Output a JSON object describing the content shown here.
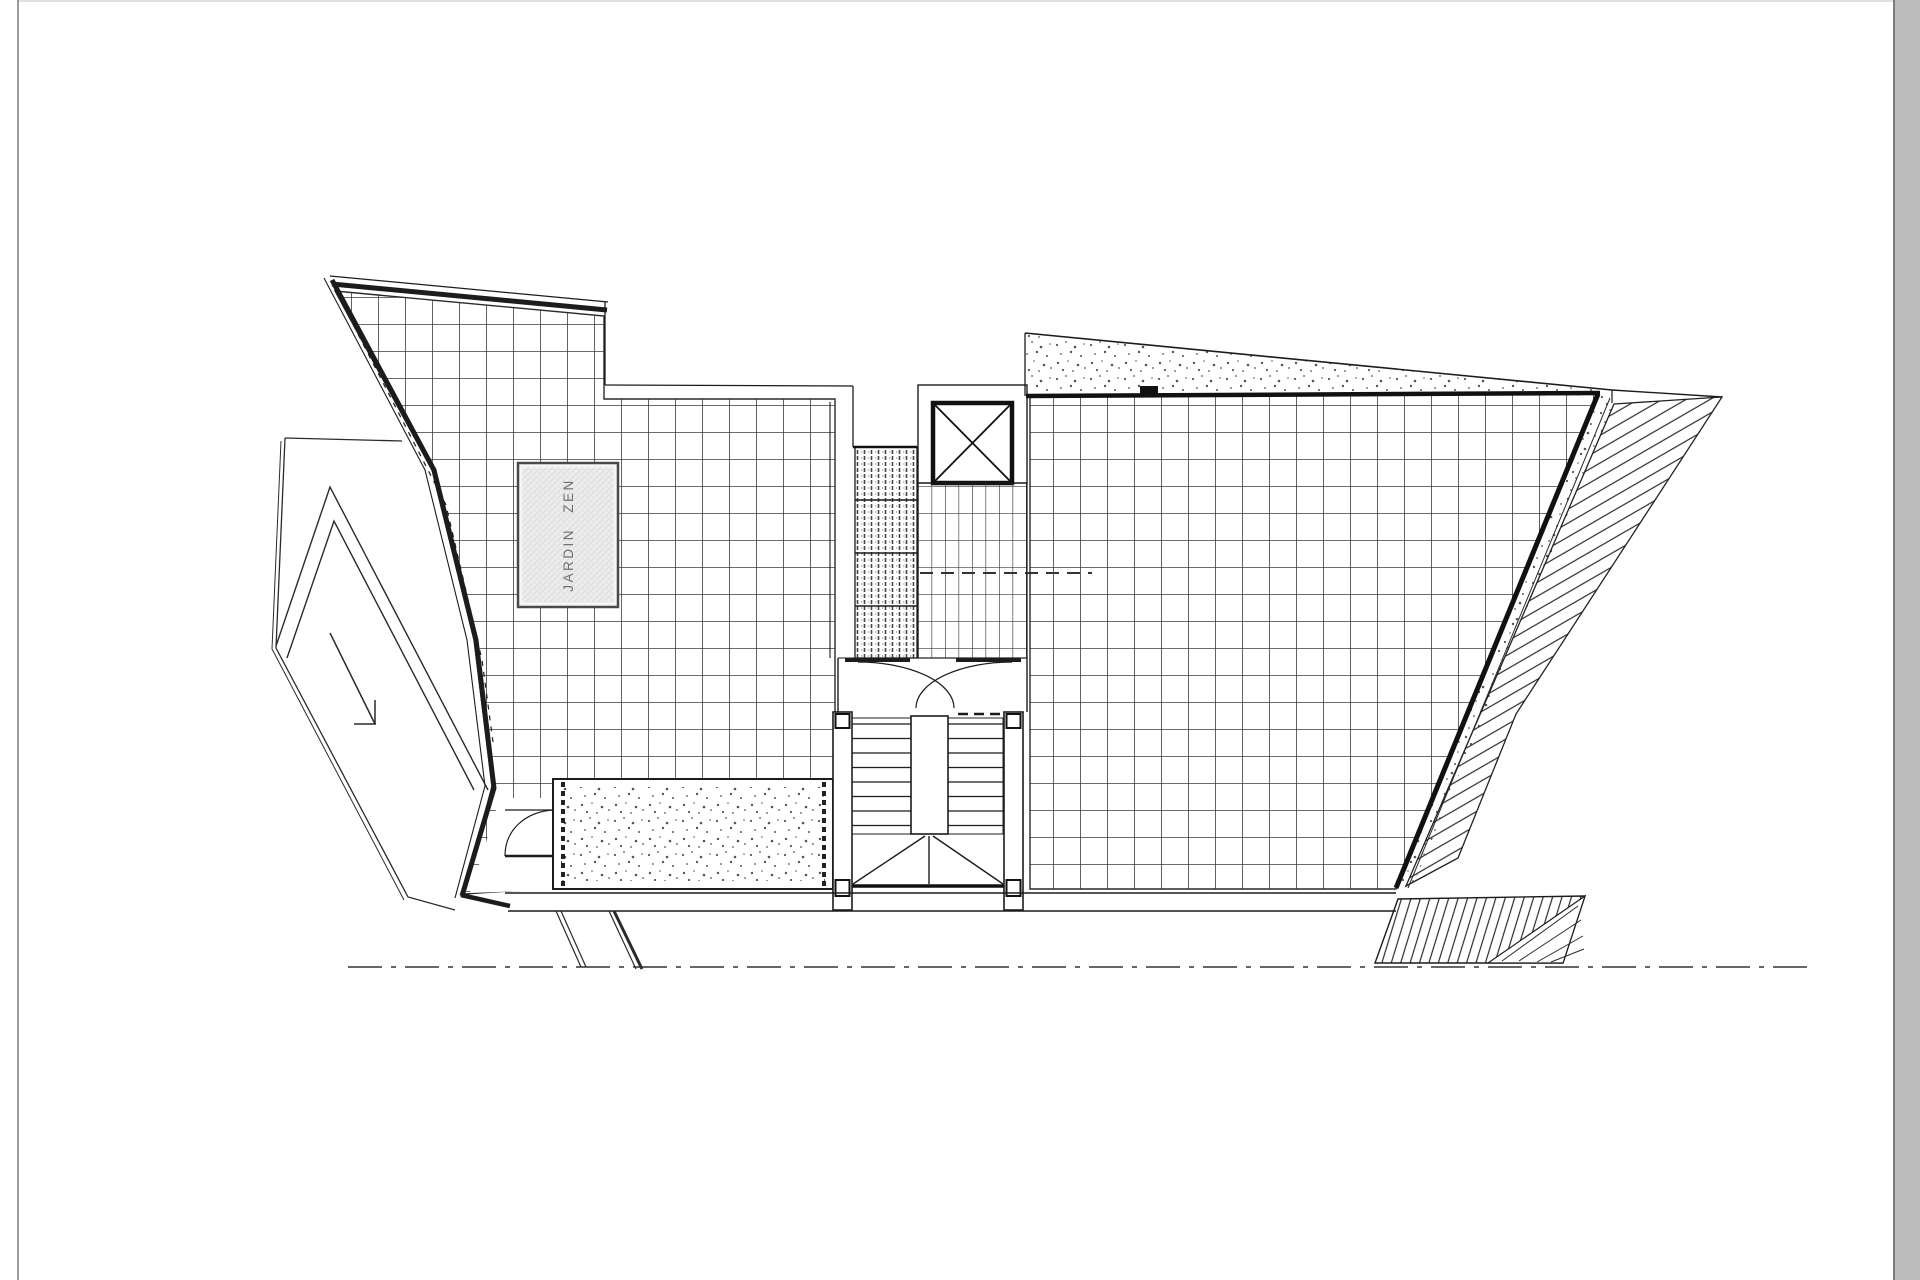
{
  "page": {
    "background": "#ffffff",
    "top_edge_color": "#e0e0e0",
    "left_edge_color": "#9a9a9a",
    "right_bar_color": "#bcbcbc",
    "right_bar_edge_color": "#7d7d7d"
  },
  "drawing": {
    "kind": "architectural-roof-terrace-plan",
    "ink_color": "#1c1c1c",
    "grid_line_color": "#3b3b3b",
    "labels": {
      "zen_garden": "JARDIN ZEN"
    },
    "zen_square": {
      "fill": "#ededed",
      "border": "#4a4a4a",
      "text_color": "#707070"
    },
    "features": [
      "left-tiled-roof-terrace",
      "zen-garden-square",
      "gravel-planter-strip",
      "access-ramp-with-direction-arrow",
      "central-grating-strip",
      "elevator-shaft-with-cross",
      "stair-landing",
      "double-swing-doors",
      "dog-leg-staircase-with-winders",
      "right-tiled-roof-terrace",
      "gravel-band-along-top-edge",
      "roof-drain-detail",
      "sloped-hatched-roof-area",
      "exterior-hatched-ramp",
      "section-axis-dash-dot-line",
      "support-struts"
    ]
  }
}
